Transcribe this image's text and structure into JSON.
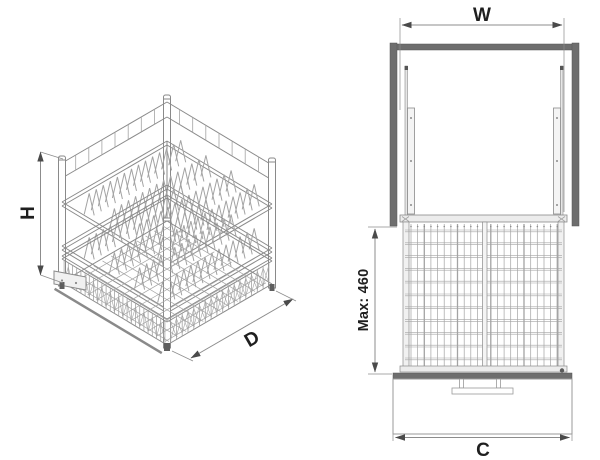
{
  "diagram": {
    "kind": "technical-drawing",
    "subject": "pull-down two-tier wire dish rack for cabinet",
    "views": [
      "isometric",
      "front"
    ]
  },
  "labels": {
    "width": "W",
    "height": "H",
    "depth": "D",
    "front_width": "C",
    "max_height": "Max: 460"
  },
  "colors": {
    "panel_dark": "#6e6e6e",
    "panel_edge": "#555555",
    "rail_stroke": "#8a8a8a",
    "rail_fill": "#ececec",
    "wire": "#a3a3a3",
    "dim": "#8c8c8c",
    "arrow": "#4a4a4a",
    "text": "#1f1f1f",
    "background": "#ffffff"
  }
}
